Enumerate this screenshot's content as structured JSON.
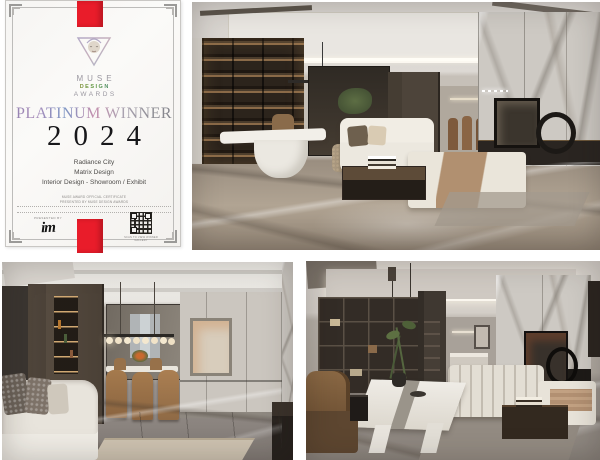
{
  "collage": {
    "background": "#ffffff",
    "description": "Award collage: MUSE Design Awards platinum certificate with three interior design photographs"
  },
  "certificate": {
    "ribbon_color": "#e91c2a",
    "paper_color": "#f9f8f5",
    "logo": {
      "line1": "MUSE",
      "line2": "DESIGN",
      "line3": "AWARDS"
    },
    "award_title": "PLATINUM WINNER",
    "year": "2024",
    "project": "Radiance City",
    "designer": "Matrix Design",
    "category": "Interior Design - Showroom / Exhibit",
    "fine_print_line1": "MUSE AWARD OFFICIAL CERTIFICATE",
    "fine_print_line2": "PRESENTED BY MUSE DESIGN AWARDS",
    "presented_by_label": "PRESENTED BY",
    "presenter_logo_text": "im",
    "qr_caption": "SCAN TO VIEW WINNER GALLERY"
  },
  "photos": [
    {
      "label": "Showroom living room with backlit display shelving, white sculptural desk, cream sofa and daybed, dark coffee table and grey marble feature wall"
    },
    {
      "label": "Dining area with dark display cabinet, linear glass-globe chandelier, tan leather dining chairs, framed art and marble floor"
    },
    {
      "label": "Lounge with white marble tea table, green branch centerpiece, brown leather armchair, channel-stitched cream sofa and marble wall"
    }
  ]
}
